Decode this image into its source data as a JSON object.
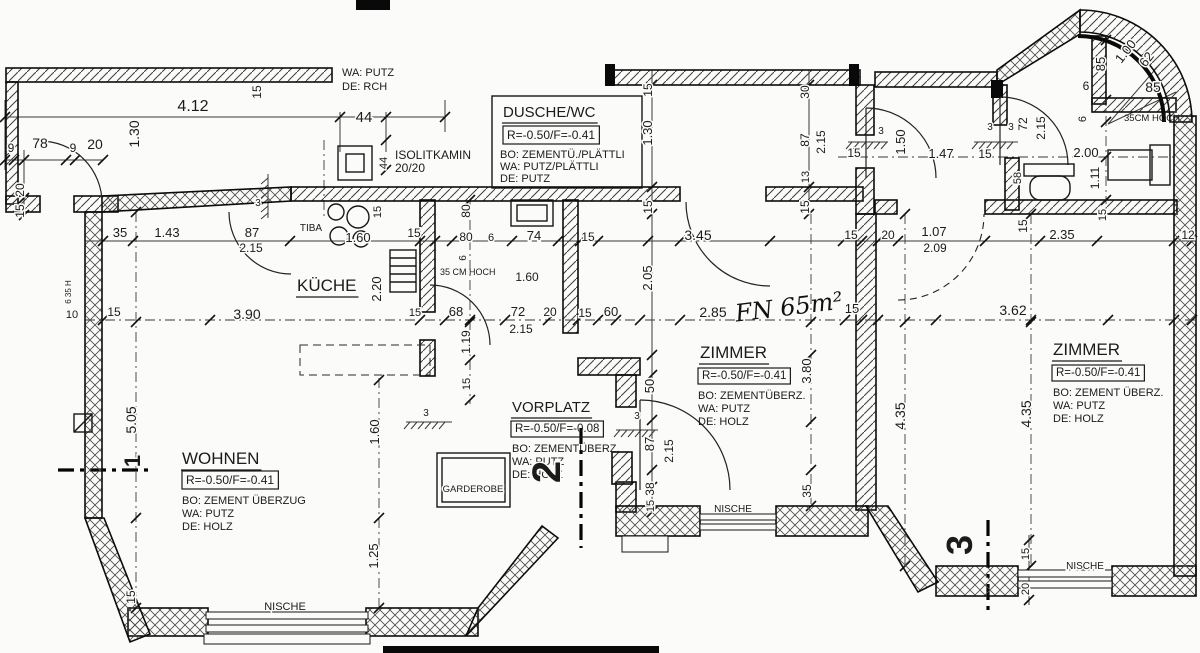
{
  "meta": {
    "drawing_type": "Wohnungsgrundriss / apartment floor plan",
    "language": "de",
    "ink_color": "#1b1b1b",
    "paper_color": "#fbfbf9"
  },
  "rooms": [
    {
      "id": "kueche",
      "name": "KÜCHE"
    },
    {
      "id": "wohnen",
      "name": "WOHNEN",
      "level": "R=-0.50/F=-0.41",
      "floor": "BO: ZEMENT ÜBERZUG",
      "wall": "WA: PUTZ",
      "ceiling": "DE: HOLZ"
    },
    {
      "id": "vorplatz",
      "name": "VORPLATZ",
      "level": "R=-0.50/F=-0.08",
      "floor": "BO: ZEMENTÜBERZ.",
      "wall": "WA: PUTZ",
      "ceiling": "DE: HOLZ"
    },
    {
      "id": "dusche-wc",
      "name": "DUSCHE/WC",
      "level": "R=-0.50/F=-0.41",
      "floor": "BO: ZEMENTÜ./PLÄTTLI",
      "wall": "WA: PUTZ/PLÄTTLI",
      "ceiling": "DE: PUTZ"
    },
    {
      "id": "zimmer-1",
      "name": "ZIMMER",
      "level": "R=-0.50/F=-0.41",
      "floor": "BO: ZEMENTÜBERZ.",
      "wall": "WA: PUTZ",
      "ceiling": "DE: HOLZ"
    },
    {
      "id": "zimmer-2",
      "name": "ZIMMER",
      "level": "R=-0.50/F=-0.41",
      "floor": "BO: ZEMENT ÜBERZ.",
      "wall": "WA: PUTZ",
      "ceiling": "DE: HOLZ"
    }
  ],
  "annotations": {
    "top_note": [
      "WA: PUTZ",
      "DE: RCH"
    ],
    "chimney": [
      "ISOLITKAMIN",
      "20/20"
    ],
    "stove": "TIBA",
    "niche": "NISCHE",
    "wardrobe": "GARDEROBE",
    "parapet_note": "35CM HOCH",
    "parapet_note_2": "35 CM HOCH",
    "handwritten_area": "FN 65m²",
    "section_markers": [
      "1",
      "2",
      "3"
    ]
  },
  "labels": [
    {
      "t": "9",
      "x": 11,
      "y": 152,
      "s": 12
    },
    {
      "t": "78",
      "x": 40,
      "y": 148,
      "s": 14
    },
    {
      "t": "9",
      "x": 73,
      "y": 152,
      "s": 12
    },
    {
      "t": "20",
      "x": 95,
      "y": 149,
      "s": 14
    },
    {
      "t": "20",
      "x": 24,
      "y": 190,
      "r": -90,
      "s": 12
    },
    {
      "t": "15",
      "x": 24,
      "y": 211,
      "r": -90,
      "s": 12
    },
    {
      "t": "4.12",
      "x": 193,
      "y": 111,
      "s": 16
    },
    {
      "t": "1.30",
      "x": 139,
      "y": 134,
      "r": -90,
      "s": 14
    },
    {
      "t": "15",
      "x": 261,
      "y": 92,
      "r": -90,
      "s": 12
    },
    {
      "t": "44",
      "x": 364,
      "y": 122,
      "s": 15
    },
    {
      "t": "44",
      "x": 387,
      "y": 163,
      "r": -90,
      "s": 11
    },
    {
      "n": "wall-note",
      "bind": "annotations.top_note.0",
      "x": 342,
      "y": 76,
      "a": "s",
      "s": 11
    },
    {
      "n": "wall-note",
      "bind": "annotations.top_note.1",
      "x": 342,
      "y": 90,
      "a": "s",
      "s": 11
    },
    {
      "n": "chimney-label",
      "bind": "annotations.chimney.0",
      "x": 395,
      "y": 159,
      "a": "s",
      "s": 12
    },
    {
      "n": "chimney-label",
      "bind": "annotations.chimney.1",
      "x": 395,
      "y": 172,
      "a": "s",
      "s": 12
    },
    {
      "t": "3",
      "x": 258,
      "y": 206,
      "s": 10
    },
    {
      "t": "15",
      "x": 381,
      "y": 212,
      "r": -90,
      "s": 11
    },
    {
      "n": "room-dusche-name",
      "bind": "rooms.3.name",
      "x": 503,
      "y": 117,
      "a": "s",
      "s": 15,
      "u": 1
    },
    {
      "n": "room-dusche-level",
      "bind": "rooms.3.level",
      "x": 507,
      "y": 139,
      "a": "s",
      "s": 12,
      "box": 1
    },
    {
      "n": "room-dusche-floor",
      "bind": "rooms.3.floor",
      "x": 500,
      "y": 158,
      "a": "s",
      "s": 11
    },
    {
      "n": "room-dusche-wall",
      "bind": "rooms.3.wall",
      "x": 500,
      "y": 170,
      "a": "s",
      "s": 11
    },
    {
      "n": "room-dusche-ceiling",
      "bind": "rooms.3.ceiling",
      "x": 500,
      "y": 182,
      "a": "s",
      "s": 11
    },
    {
      "t": "15",
      "x": 652,
      "y": 90,
      "r": -90,
      "s": 12
    },
    {
      "t": "1.30",
      "x": 652,
      "y": 133,
      "r": -90,
      "s": 13
    },
    {
      "t": "15",
      "x": 652,
      "y": 207,
      "r": -90,
      "s": 12
    },
    {
      "t": "30",
      "x": 809,
      "y": 92,
      "r": -90,
      "s": 12
    },
    {
      "t": "87",
      "x": 809,
      "y": 140,
      "r": -90,
      "s": 12
    },
    {
      "t": "2.15",
      "x": 825,
      "y": 142,
      "r": -90,
      "s": 12
    },
    {
      "t": "13",
      "x": 809,
      "y": 177,
      "r": -90,
      "s": 11
    },
    {
      "t": "15",
      "x": 809,
      "y": 207,
      "r": -90,
      "s": 12
    },
    {
      "t": "3",
      "x": 881,
      "y": 134,
      "s": 10
    },
    {
      "t": "15",
      "x": 854,
      "y": 157,
      "s": 12
    },
    {
      "t": "1.50",
      "x": 905,
      "y": 142,
      "r": -90,
      "s": 13
    },
    {
      "t": "1.47",
      "x": 941,
      "y": 158,
      "s": 13
    },
    {
      "t": "3",
      "x": 990,
      "y": 130,
      "s": 10
    },
    {
      "t": "3",
      "x": 1011,
      "y": 130,
      "s": 10
    },
    {
      "t": "15",
      "x": 985,
      "y": 158,
      "s": 12
    },
    {
      "t": "72",
      "x": 1027,
      "y": 124,
      "r": -90,
      "s": 12
    },
    {
      "t": "2.15",
      "x": 1045,
      "y": 128,
      "r": -90,
      "s": 12
    },
    {
      "t": "2.00",
      "x": 1086,
      "y": 157,
      "s": 13
    },
    {
      "t": "1.11",
      "x": 1099,
      "y": 178,
      "r": -90,
      "s": 12
    },
    {
      "t": "58",
      "x": 1021,
      "y": 178,
      "r": -90,
      "s": 11
    },
    {
      "t": "85",
      "x": 1105,
      "y": 64,
      "r": -90,
      "s": 13
    },
    {
      "t": "1.00",
      "x": 1129,
      "y": 54,
      "r": -52,
      "s": 13
    },
    {
      "t": "62",
      "x": 1150,
      "y": 62,
      "r": -52,
      "s": 13
    },
    {
      "t": "85",
      "x": 1153,
      "y": 92,
      "s": 14
    },
    {
      "t": "6",
      "x": 1086,
      "y": 90,
      "s": 12
    },
    {
      "t": "6",
      "x": 1086,
      "y": 119,
      "r": -90,
      "s": 11
    },
    {
      "n": "parapet-note",
      "bind": "annotations.parapet_note",
      "x": 1124,
      "y": 121,
      "a": "s",
      "s": 9.5
    },
    {
      "t": "35",
      "x": 120,
      "y": 237,
      "s": 13
    },
    {
      "t": "1.43",
      "x": 167,
      "y": 237,
      "s": 13
    },
    {
      "t": "87",
      "x": 252,
      "y": 237,
      "s": 13
    },
    {
      "t": "2.15",
      "x": 251,
      "y": 252,
      "s": 12
    },
    {
      "n": "stove-label",
      "bind": "annotations.stove",
      "x": 311,
      "y": 231,
      "s": 10
    },
    {
      "t": "1.60",
      "x": 358,
      "y": 242,
      "s": 13
    },
    {
      "t": "15",
      "x": 414,
      "y": 237,
      "s": 12
    },
    {
      "t": "80",
      "x": 470,
      "y": 211,
      "r": -90,
      "s": 12
    },
    {
      "t": "80",
      "x": 466,
      "y": 241,
      "s": 12
    },
    {
      "t": "6",
      "x": 491,
      "y": 241,
      "s": 11
    },
    {
      "t": "74",
      "x": 534,
      "y": 240,
      "s": 13
    },
    {
      "t": "15",
      "x": 588,
      "y": 241,
      "s": 12
    },
    {
      "t": "3.45",
      "x": 698,
      "y": 240,
      "s": 14
    },
    {
      "t": "15",
      "x": 851,
      "y": 239,
      "s": 12
    },
    {
      "t": "20",
      "x": 888,
      "y": 239,
      "s": 12
    },
    {
      "t": "1.07",
      "x": 934,
      "y": 236,
      "s": 13
    },
    {
      "t": "2.09",
      "x": 935,
      "y": 252,
      "s": 12
    },
    {
      "t": "15",
      "x": 1027,
      "y": 226,
      "r": -90,
      "s": 12
    },
    {
      "t": "2.35",
      "x": 1062,
      "y": 239,
      "s": 13
    },
    {
      "t": "12",
      "x": 1188,
      "y": 239,
      "s": 12
    },
    {
      "t": "15",
      "x": 1106,
      "y": 215,
      "r": -90,
      "s": 11
    },
    {
      "n": "room-kueche-name",
      "bind": "rooms.0.name",
      "x": 297,
      "y": 291,
      "a": "s",
      "s": 17,
      "u": 1
    },
    {
      "t": "2.20",
      "x": 381,
      "y": 289,
      "r": -90,
      "s": 13
    },
    {
      "t": "6",
      "x": 466,
      "y": 258,
      "r": -90,
      "s": 10
    },
    {
      "n": "parapet-note-2",
      "bind": "annotations.parapet_note_2",
      "x": 440,
      "y": 275,
      "a": "s",
      "s": 9
    },
    {
      "t": "1.60",
      "x": 527,
      "y": 281,
      "s": 12
    },
    {
      "t": "2.05",
      "x": 652,
      "y": 278,
      "r": -90,
      "s": 13
    },
    {
      "t": "10",
      "x": 72,
      "y": 318,
      "s": 11
    },
    {
      "t": "15",
      "x": 114,
      "y": 316,
      "s": 12
    },
    {
      "t": "3.90",
      "x": 247,
      "y": 319,
      "s": 14
    },
    {
      "t": "15",
      "x": 415,
      "y": 316,
      "s": 11
    },
    {
      "t": "68",
      "x": 456,
      "y": 316,
      "s": 13
    },
    {
      "t": "72",
      "x": 518,
      "y": 316,
      "s": 13
    },
    {
      "t": "20",
      "x": 550,
      "y": 316,
      "s": 12
    },
    {
      "t": "2.15",
      "x": 521,
      "y": 333,
      "s": 12
    },
    {
      "t": "15",
      "x": 585,
      "y": 317,
      "s": 12
    },
    {
      "t": "60",
      "x": 611,
      "y": 316,
      "s": 13
    },
    {
      "t": "2.85",
      "x": 713,
      "y": 317,
      "s": 14
    },
    {
      "n": "handwritten-area-note",
      "hand": 1,
      "bind": "annotations.handwritten_area",
      "x": 790,
      "y": 315,
      "s": 24,
      "r": -7
    },
    {
      "t": "15",
      "x": 852,
      "y": 313,
      "s": 13
    },
    {
      "t": "3.62",
      "x": 1013,
      "y": 315,
      "s": 14
    },
    {
      "t": "6 35 H",
      "x": 71,
      "y": 292,
      "r": -90,
      "s": 8
    },
    {
      "t": "5.05",
      "x": 136,
      "y": 420,
      "r": -90,
      "s": 14
    },
    {
      "t": "1.19",
      "x": 470,
      "y": 342,
      "r": -90,
      "s": 12
    },
    {
      "t": "15",
      "x": 470,
      "y": 384,
      "r": -90,
      "s": 11
    },
    {
      "t": "1.60",
      "x": 379,
      "y": 432,
      "r": -90,
      "s": 13
    },
    {
      "t": "1.25",
      "x": 378,
      "y": 556,
      "r": -90,
      "s": 13
    },
    {
      "t": "15",
      "x": 135,
      "y": 597,
      "r": -90,
      "s": 12
    },
    {
      "n": "room-wohnen-name",
      "bind": "rooms.1.name",
      "x": 182,
      "y": 464,
      "a": "s",
      "s": 17,
      "u": 1
    },
    {
      "n": "room-wohnen-level",
      "bind": "rooms.1.level",
      "x": 186,
      "y": 484,
      "a": "s",
      "s": 12,
      "box": 1
    },
    {
      "n": "room-wohnen-floor",
      "bind": "rooms.1.floor",
      "x": 182,
      "y": 504,
      "a": "s",
      "s": 11
    },
    {
      "n": "room-wohnen-wall",
      "bind": "rooms.1.wall",
      "x": 182,
      "y": 517,
      "a": "s",
      "s": 11
    },
    {
      "n": "room-wohnen-ceiling",
      "bind": "rooms.1.ceiling",
      "x": 182,
      "y": 530,
      "a": "s",
      "s": 11
    },
    {
      "n": "room-vorplatz-name",
      "bind": "rooms.2.name",
      "x": 512,
      "y": 412,
      "a": "s",
      "s": 15,
      "u": 1
    },
    {
      "n": "room-vorplatz-level",
      "bind": "rooms.2.level",
      "x": 515,
      "y": 432,
      "a": "s",
      "s": 11.5,
      "box": 1
    },
    {
      "n": "room-vorplatz-floor",
      "bind": "rooms.2.floor",
      "x": 512,
      "y": 452,
      "a": "s",
      "s": 11
    },
    {
      "n": "room-vorplatz-wall",
      "bind": "rooms.2.wall",
      "x": 512,
      "y": 465,
      "a": "s",
      "s": 11
    },
    {
      "n": "room-vorplatz-ceiling",
      "bind": "rooms.2.ceiling",
      "x": 512,
      "y": 478,
      "a": "s",
      "s": 11
    },
    {
      "n": "wardrobe-label",
      "bind": "annotations.wardrobe",
      "x": 473,
      "y": 492,
      "s": 9.5
    },
    {
      "t": "3",
      "x": 426,
      "y": 416,
      "s": 10
    },
    {
      "t": "3",
      "x": 637,
      "y": 419,
      "s": 10
    },
    {
      "n": "section-marker-1",
      "bind": "annotations.section_markers.0",
      "x": 140,
      "y": 461,
      "r": -90,
      "s": 22,
      "b": 1
    },
    {
      "n": "section-marker-2",
      "bind": "annotations.section_markers.1",
      "x": 560,
      "y": 472,
      "r": -90,
      "s": 40,
      "b": 1
    },
    {
      "n": "section-marker-3",
      "bind": "annotations.section_markers.2",
      "x": 972,
      "y": 545,
      "r": -90,
      "s": 36,
      "b": 1
    },
    {
      "t": "50",
      "x": 654,
      "y": 386,
      "r": -90,
      "s": 13
    },
    {
      "t": "87",
      "x": 654,
      "y": 444,
      "r": -90,
      "s": 13
    },
    {
      "t": "2.15",
      "x": 673,
      "y": 451,
      "r": -90,
      "s": 12
    },
    {
      "t": "38",
      "x": 654,
      "y": 489,
      "r": -90,
      "s": 12
    },
    {
      "t": "15",
      "x": 654,
      "y": 506,
      "r": -90,
      "s": 11
    },
    {
      "t": "3.80",
      "x": 811,
      "y": 371,
      "r": -90,
      "s": 13
    },
    {
      "t": "35",
      "x": 811,
      "y": 491,
      "r": -90,
      "s": 12
    },
    {
      "t": "4.35",
      "x": 905,
      "y": 416,
      "r": -90,
      "s": 14
    },
    {
      "t": "4.35",
      "x": 1031,
      "y": 414,
      "r": -90,
      "s": 14
    },
    {
      "n": "room-zimmer1-name",
      "bind": "rooms.4.name",
      "x": 700,
      "y": 358,
      "a": "s",
      "s": 17,
      "u": 1
    },
    {
      "n": "room-zimmer1-level",
      "bind": "rooms.4.level",
      "x": 702,
      "y": 379,
      "a": "s",
      "s": 11.5,
      "box": 1
    },
    {
      "n": "room-zimmer1-floor",
      "bind": "rooms.4.floor",
      "x": 698,
      "y": 399,
      "a": "s",
      "s": 11
    },
    {
      "n": "room-zimmer1-wall",
      "bind": "rooms.4.wall",
      "x": 698,
      "y": 412,
      "a": "s",
      "s": 11
    },
    {
      "n": "room-zimmer1-ceiling",
      "bind": "rooms.4.ceiling",
      "x": 698,
      "y": 425,
      "a": "s",
      "s": 11
    },
    {
      "n": "room-zimmer2-name",
      "bind": "rooms.5.name",
      "x": 1053,
      "y": 355,
      "a": "s",
      "s": 17,
      "u": 1
    },
    {
      "n": "room-zimmer2-level",
      "bind": "rooms.5.level",
      "x": 1056,
      "y": 376,
      "a": "s",
      "s": 11.5,
      "box": 1
    },
    {
      "n": "room-zimmer2-floor",
      "bind": "rooms.5.floor",
      "x": 1053,
      "y": 396,
      "a": "s",
      "s": 11
    },
    {
      "n": "room-zimmer2-wall",
      "bind": "rooms.5.wall",
      "x": 1053,
      "y": 409,
      "a": "s",
      "s": 11
    },
    {
      "n": "room-zimmer2-ceiling",
      "bind": "rooms.5.ceiling",
      "x": 1053,
      "y": 422,
      "a": "s",
      "s": 11
    },
    {
      "n": "niche-label",
      "bind": "annotations.niche",
      "x": 285,
      "y": 610,
      "s": 11
    },
    {
      "n": "niche-label",
      "bind": "annotations.niche",
      "x": 733,
      "y": 512,
      "s": 10
    },
    {
      "n": "niche-label",
      "bind": "annotations.niche",
      "x": 1085,
      "y": 569,
      "s": 10
    },
    {
      "t": "15",
      "x": 1029,
      "y": 554,
      "r": -90,
      "s": 11
    },
    {
      "t": "20",
      "x": 1029,
      "y": 589,
      "r": -90,
      "s": 11
    }
  ]
}
